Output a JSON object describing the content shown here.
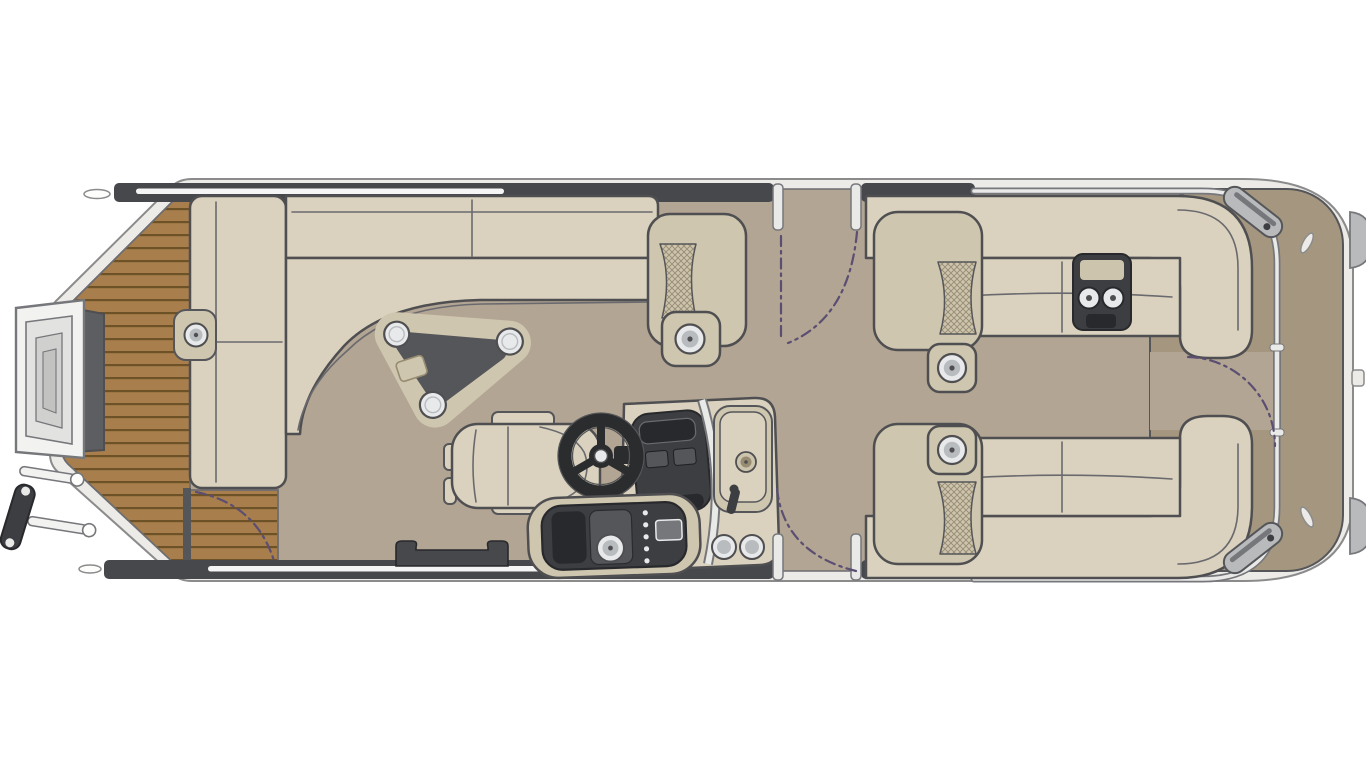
{
  "diagram": {
    "type": "pontoon-boat-floorplan",
    "view": "top-down",
    "features": [
      "bow-teak-deck",
      "bow-boarding-steps",
      "bow-ladder",
      "port-bow-bench",
      "bow-wraparound-couch",
      "teardrop-table-with-cupholders",
      "captains-chair",
      "helm-console-with-steering-wheel-and-sink",
      "stereo-console",
      "port-side-gate",
      "starboard-side-gate",
      "aft-port-lounge",
      "aft-starboard-lounge",
      "armrest-cupholders",
      "rear-gate-with-swing-arc",
      "stern-deck",
      "stern-speaker-grilles",
      "outboard-motor-mounts"
    ]
  },
  "colors": {
    "page_bg": "#ffffff",
    "hull_band": "#ecebe8",
    "hull_edge": "#8b8b8b",
    "deck_edge": "#6d6d70",
    "floor": "#b2a593",
    "wood": "#a87f4c",
    "wood_line": "#6d5127",
    "stern_deck": "#a5977f",
    "rail": "#47484c",
    "rail_highlight": "#ffffff",
    "chrome": "#e9e9e7",
    "chrome_edge": "#76777b",
    "seat": "#dad2bf",
    "seat_base": "#cfc6af",
    "outline": "#4f4f52",
    "mesh_base": "#cdc4ad",
    "mesh_line": "#978c72",
    "dark": "#3d3e42",
    "dark2": "#28292c",
    "panel": "#55565a",
    "cup": "#e7e9eb",
    "cup_mid": "#b9bcbf",
    "table_top": "#55565a",
    "arc": "#5b4e72",
    "step_white": "#f2f2f0",
    "step_gray": "#5d5e62",
    "speaker": "#b9babc",
    "wheel": "#2b2c2e",
    "white": "#fdfdfc"
  }
}
